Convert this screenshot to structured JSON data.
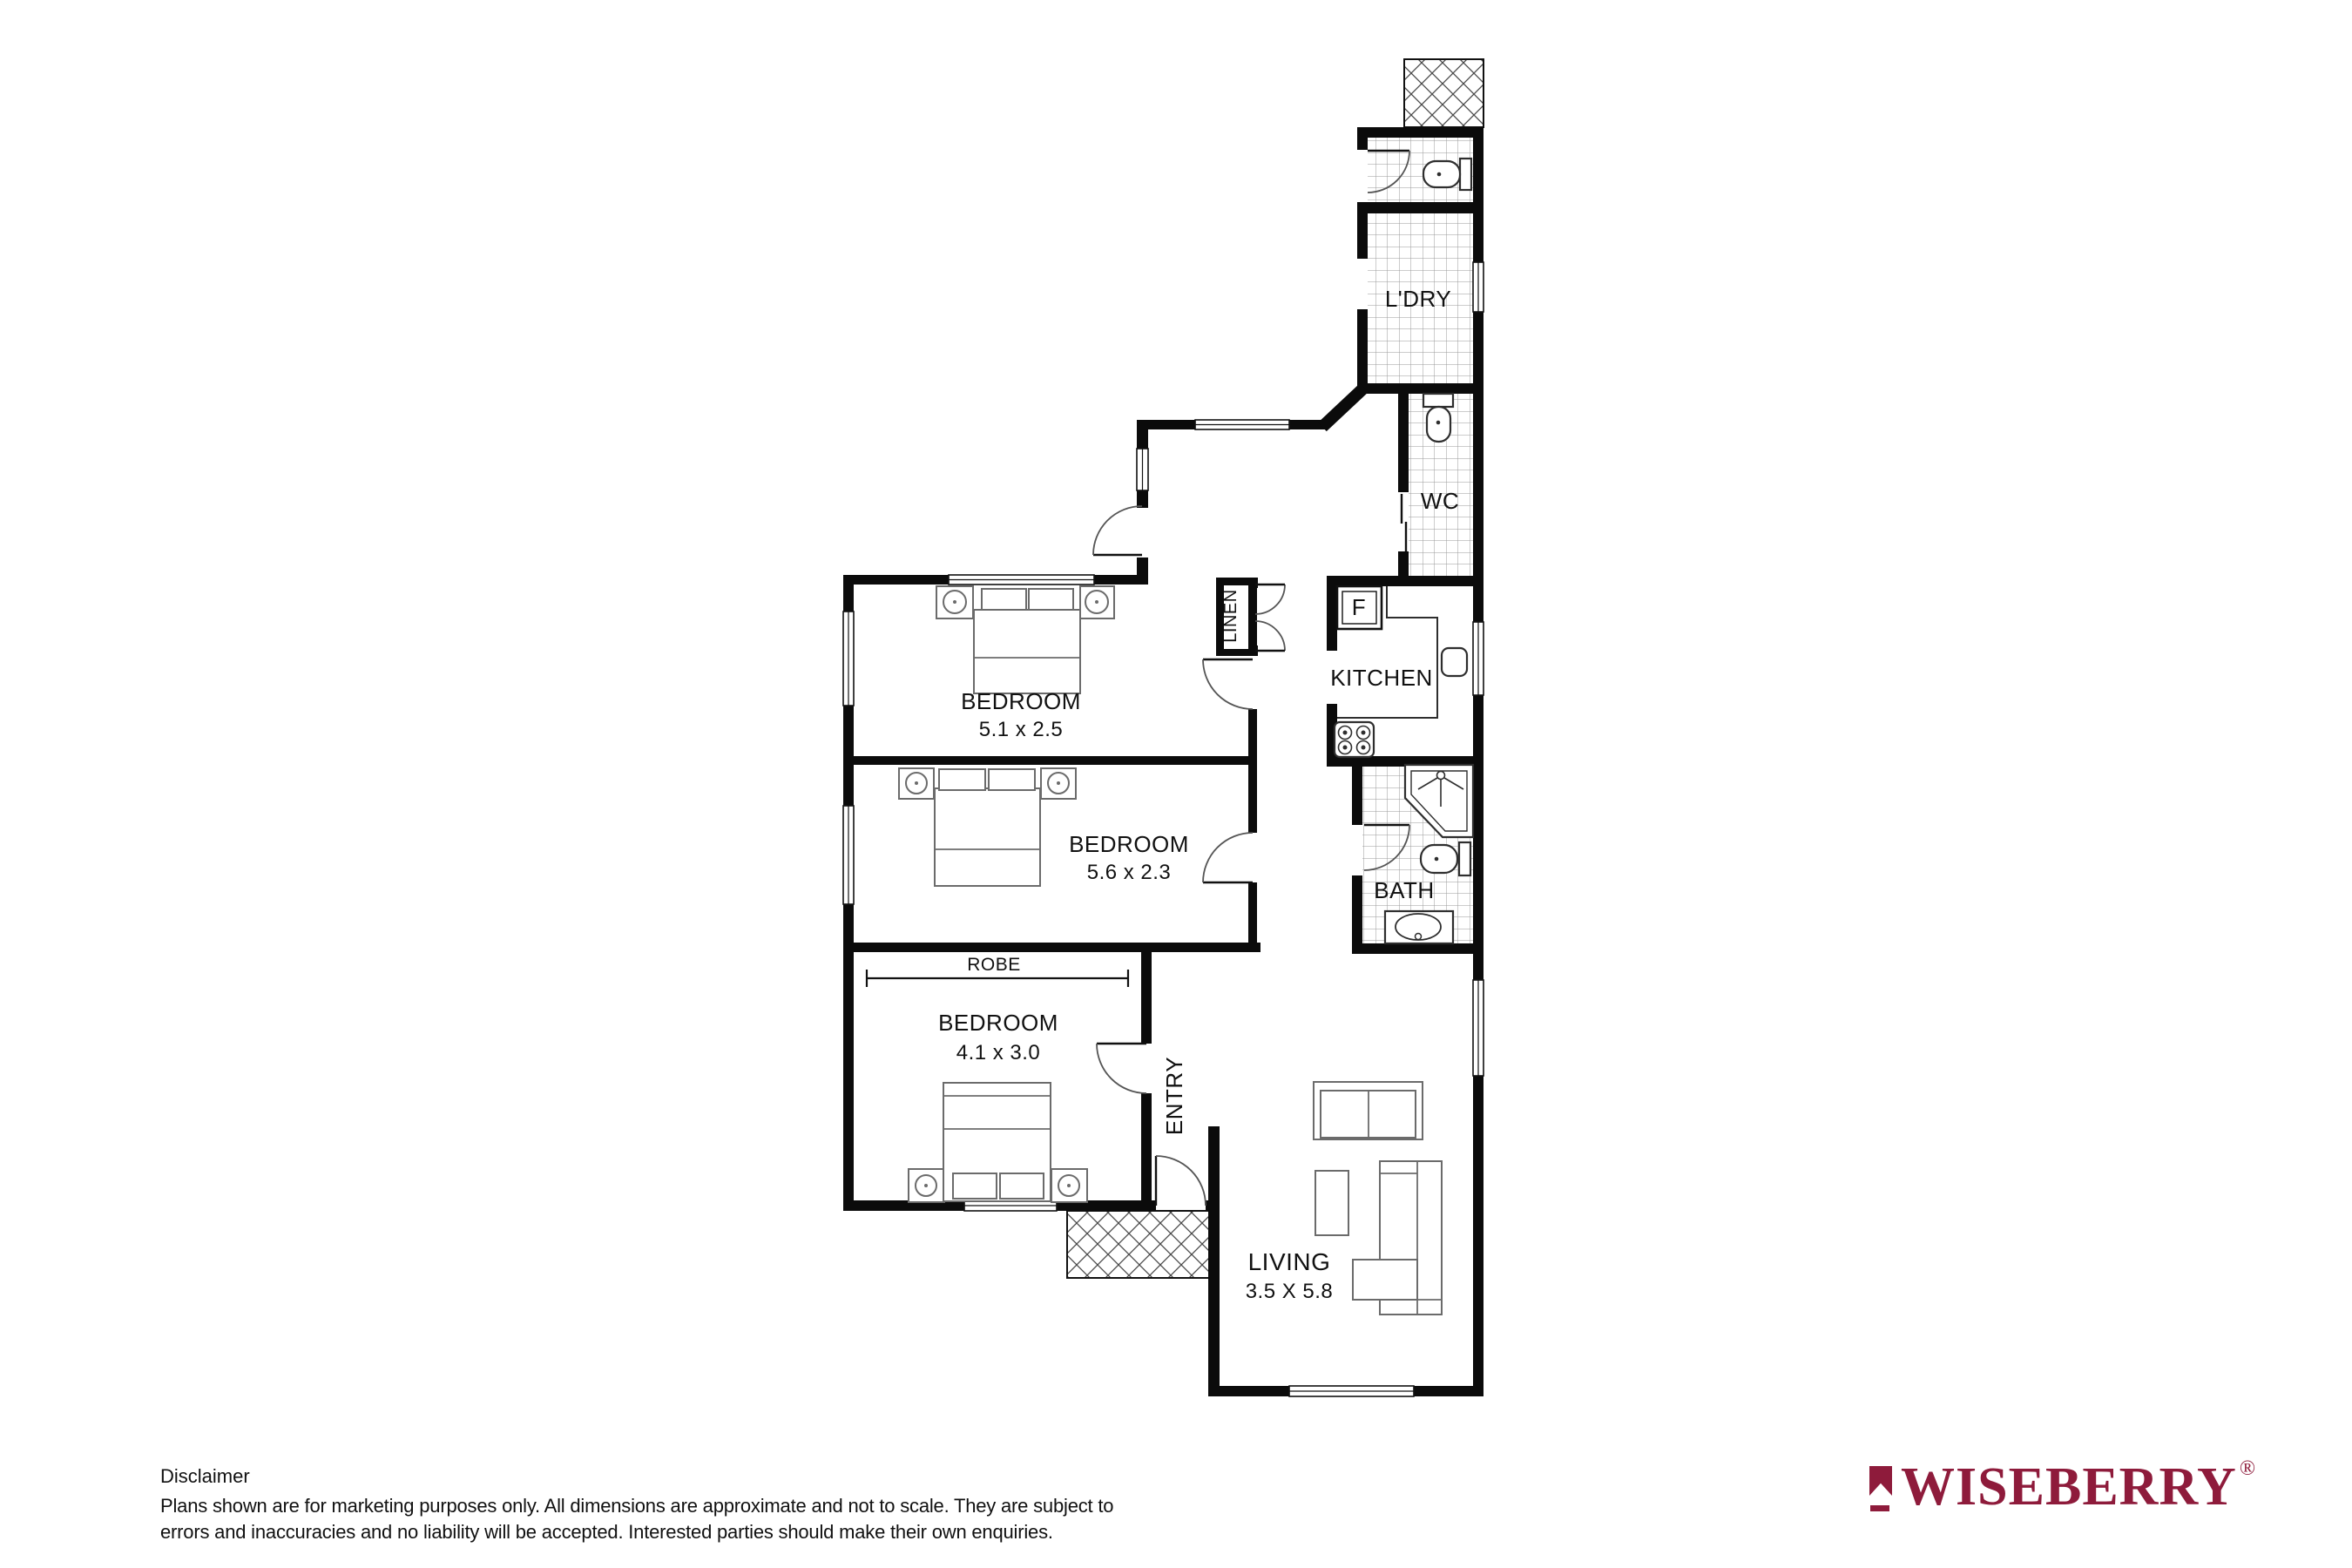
{
  "plan": {
    "rooms": {
      "laundry": {
        "label": "L'DRY"
      },
      "wc": {
        "label": "WC"
      },
      "kitchen": {
        "label": "KITCHEN",
        "fridge": "F"
      },
      "bath": {
        "label": "BATH"
      },
      "bedroom1": {
        "label": "BEDROOM",
        "dims": "5.1 x 2.5"
      },
      "bedroom2": {
        "label": "BEDROOM",
        "dims": "5.6 x 2.3"
      },
      "bedroom3": {
        "label": "BEDROOM",
        "dims": "4.1 x 3.0"
      },
      "robe": {
        "label": "ROBE"
      },
      "linen": {
        "label": "LINEN"
      },
      "entry": {
        "label": "ENTRY"
      },
      "living": {
        "label": "LIVING",
        "dims": "3.5 X 5.8"
      }
    }
  },
  "disclaimer": {
    "title": "Disclaimer",
    "line1": "Plans shown are for marketing purposes only. All dimensions are  approximate and not to scale. They are subject to",
    "line2": "errors and inaccuracies and  no liability will be accepted. Interested parties should make their own enquiries."
  },
  "brand": {
    "name": "WISEBERRY",
    "registered": "®",
    "color": "#8E1B3B"
  }
}
